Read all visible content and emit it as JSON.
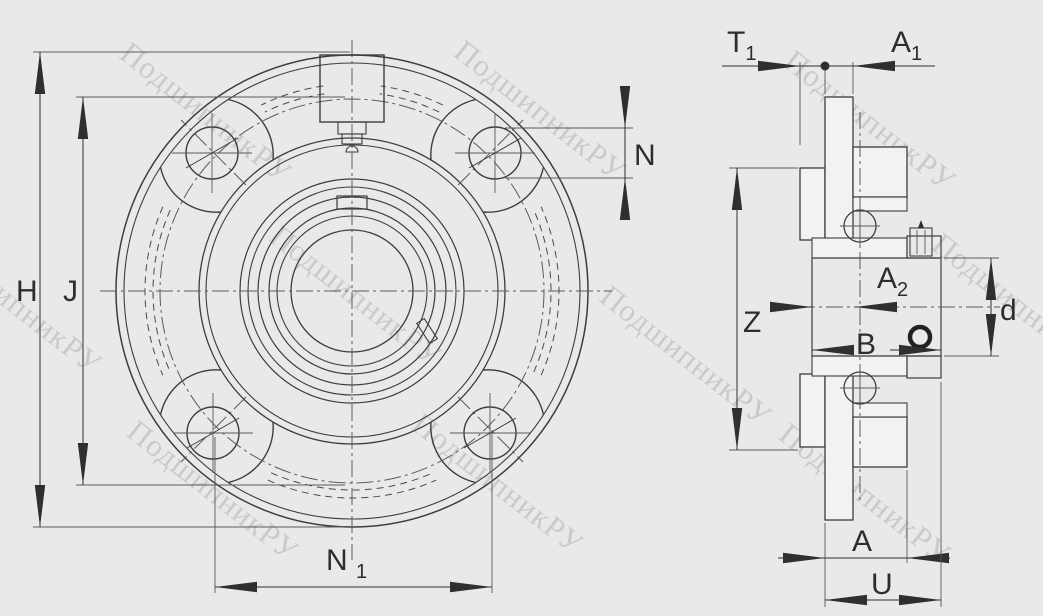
{
  "drawing": {
    "type": "bearing-unit-technical-drawing",
    "views": {
      "front_view": "four-bolt-flanged-cartridge-housing-front",
      "side_view": "housing-cross-section"
    }
  },
  "labels": {
    "H": {
      "text": "H"
    },
    "J": {
      "text": "J"
    },
    "N": {
      "text": "N"
    },
    "N1": {
      "text": "N",
      "sub": "1"
    },
    "T1": {
      "text": "T",
      "sub": "1"
    },
    "A1": {
      "text": "A",
      "sub": "1"
    },
    "A2": {
      "text": "A",
      "sub": "2"
    },
    "Z": {
      "text": "Z"
    },
    "B": {
      "text": "B"
    },
    "d": {
      "text": "d"
    },
    "A": {
      "text": "A"
    },
    "U": {
      "text": "U"
    }
  },
  "watermark": {
    "text": "ПодшипникРУ"
  },
  "colors": {
    "background": "#e9e9e9",
    "line": "#3d3d3d",
    "dimension": "#2f2f2f",
    "part_fill": "#f0f0f0",
    "bore_fill": "#e2e2e2",
    "watermark": "#8d8d8d"
  }
}
